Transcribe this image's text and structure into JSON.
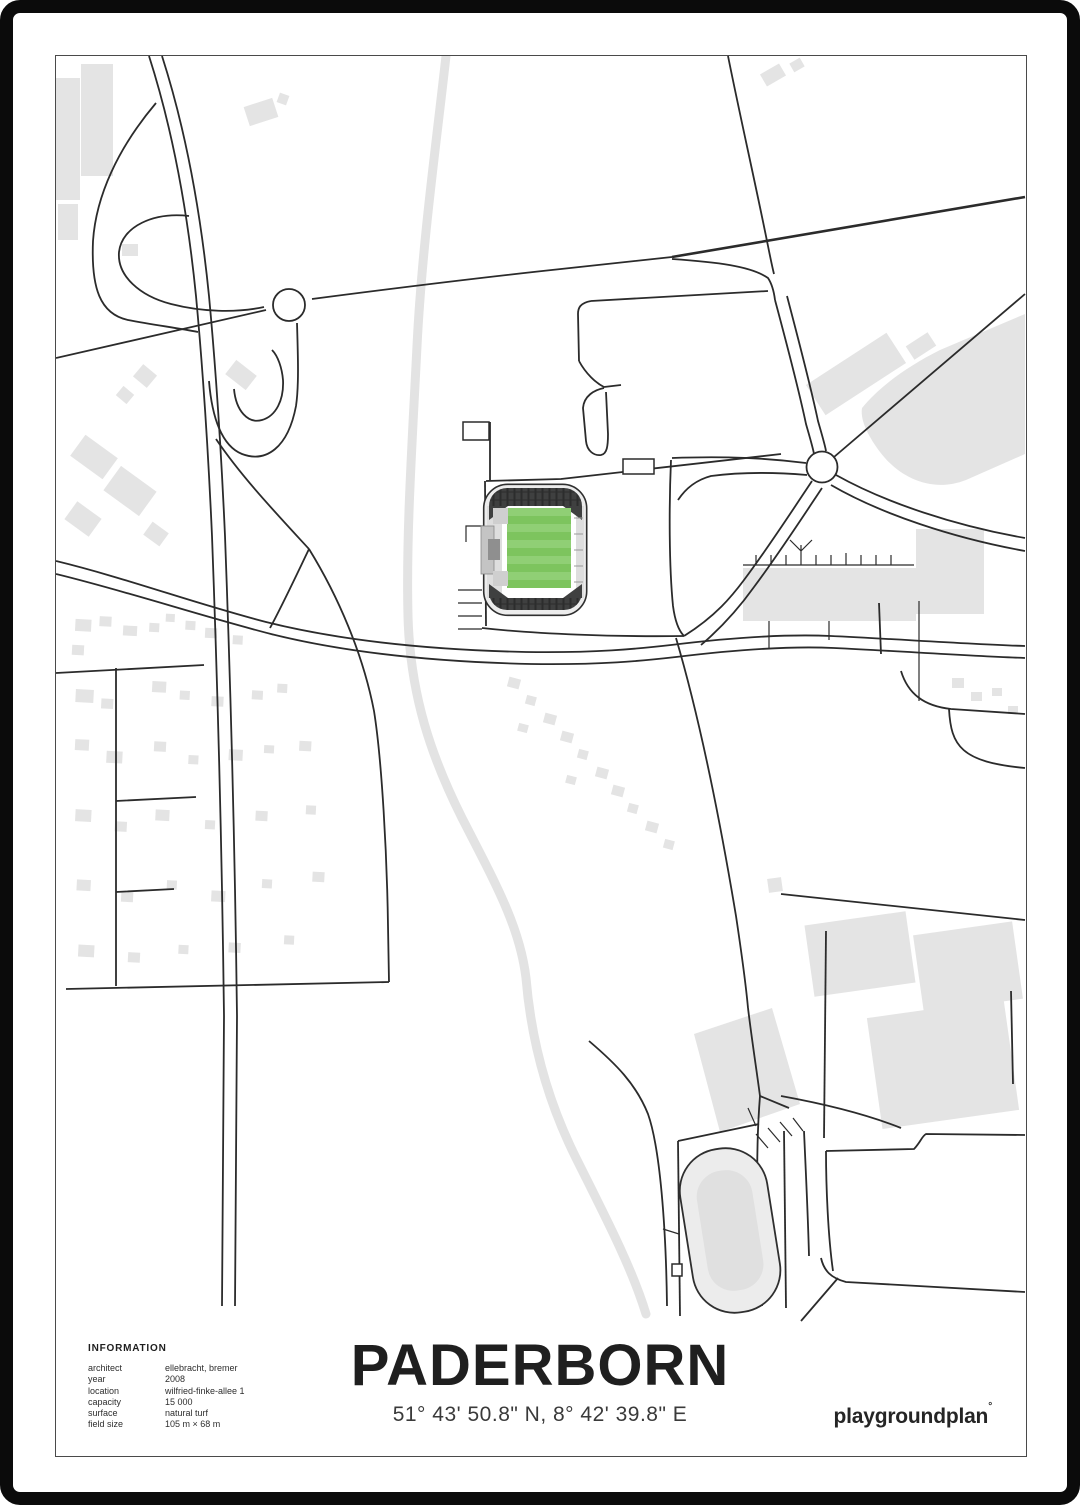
{
  "poster": {
    "title": "PADERBORN",
    "coordinates": "51° 43' 50.8\" N, 8° 42' 39.8\" E",
    "brand": "playgroundplan",
    "brand_mark": "°"
  },
  "information": {
    "header": "INFORMATION",
    "rows": [
      {
        "label": "architect",
        "value": "ellebracht, bremer"
      },
      {
        "label": "year",
        "value": "2008"
      },
      {
        "label": "location",
        "value": "wilfried-finke-allee 1"
      },
      {
        "label": "capacity",
        "value": "15 000"
      },
      {
        "label": "surface",
        "value": "natural turf"
      },
      {
        "label": "field size",
        "value": "105 m × 68 m"
      }
    ]
  },
  "colors": {
    "pitch-green": "#7dc45e",
    "pitch-stripe": "#90cf75",
    "stand-dark": "#3f4040",
    "stand-hatch": "#2c2d2d",
    "stand-light": "#dedede",
    "building-gray": "#e4e4e4",
    "river-gray": "#e3e3e3",
    "road-black": "#2b2b2b",
    "frame-black": "#0b0b0b"
  }
}
